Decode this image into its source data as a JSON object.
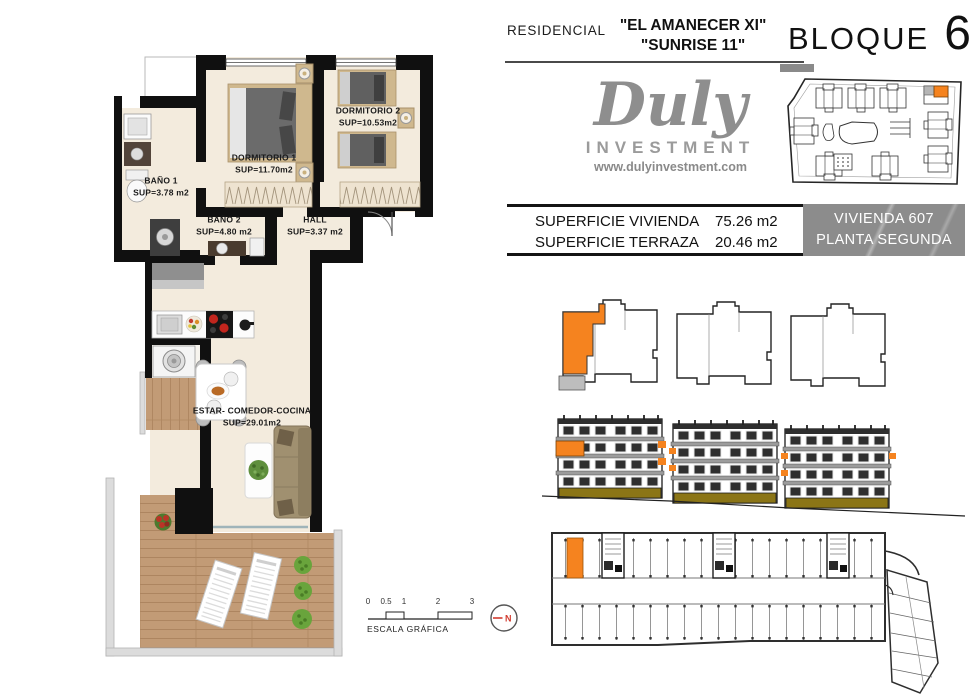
{
  "header": {
    "residencial": "RESIDENCIAL",
    "name_line1": "\"EL AMANECER XI\"",
    "name_line2": "\"SUNRISE 11\"",
    "bloque_label": "BLOQUE",
    "bloque_number": "6"
  },
  "logo": {
    "name": "Duly",
    "subtitle": "INVESTMENT",
    "website": "www.dulyinvestment.com"
  },
  "summary": {
    "rows": [
      {
        "label": "SUPERFICIE VIVIENDA",
        "value": "75.26 m2"
      },
      {
        "label": "SUPERFICIE TERRAZA",
        "value": "20.46 m2"
      }
    ],
    "unit_line1": "VIVIENDA 607",
    "unit_line2": "PLANTA SEGUNDA"
  },
  "floorplan": {
    "rooms": [
      {
        "name": "BAÑO 1",
        "area": "SUP=3.78 m2"
      },
      {
        "name": "DORMITORIO 1",
        "area": "SUP=11.70m2"
      },
      {
        "name": "DORMITORIO 2",
        "area": "SUP=10.53m2"
      },
      {
        "name": "BAÑO 2",
        "area": "SUP=4.80 m2"
      },
      {
        "name": "HALL",
        "area": "SUP=3.37 m2"
      },
      {
        "name": "ESTAR- COMEDOR-COCINA",
        "area": "SUP=29.01m2"
      }
    ]
  },
  "scale": {
    "title": "ESCALA GRÁFICA",
    "ticks": [
      "0",
      "0.5",
      "1",
      "2",
      "3"
    ],
    "north_label": "N"
  },
  "colors": {
    "highlight_orange": "#f5831f",
    "unit_box_gray": "#8c8c8c",
    "wall_black": "#101010",
    "floor_beige": "#f3ebdd",
    "deck_wood": "#c29b76",
    "base_olive": "#8b7516",
    "north_red": "#d23b2f"
  }
}
